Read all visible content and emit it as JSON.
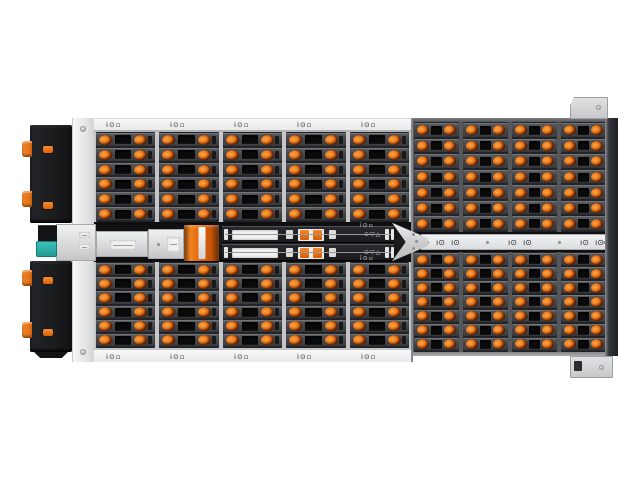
{
  "meta": {
    "type": "product-photo",
    "subject": "Top view of a high-density 4U rackmount JBOD storage enclosure with hot-swap drive bays, orange release latches, center I/O module band and rail brackets",
    "background": "#ffffff"
  },
  "colors": {
    "latch_orange": "#e06a10",
    "accent_orange": "#e87722",
    "chassis_silver": "#e9ebed",
    "carrier_gray": "#46474b",
    "bay_black": "#0b0b0c",
    "rear_panel_black": "#1b1c1e",
    "teal_latch": "#2fb3ad",
    "edge_dark": "#26272b"
  },
  "marks": {
    "rail": "i⊙▫",
    "bar_unit": "ı⊙",
    "tray": "⊙▽△"
  },
  "enclosure": {
    "sections": {
      "left_top": {
        "cols": 5,
        "rows": 6
      },
      "left_bottom": {
        "cols": 5,
        "rows": 6
      },
      "right_top": {
        "cols": 4,
        "rows": 7
      },
      "right_bottom": {
        "cols": 4,
        "rows": 7
      }
    },
    "latches_per_bay": 2
  }
}
